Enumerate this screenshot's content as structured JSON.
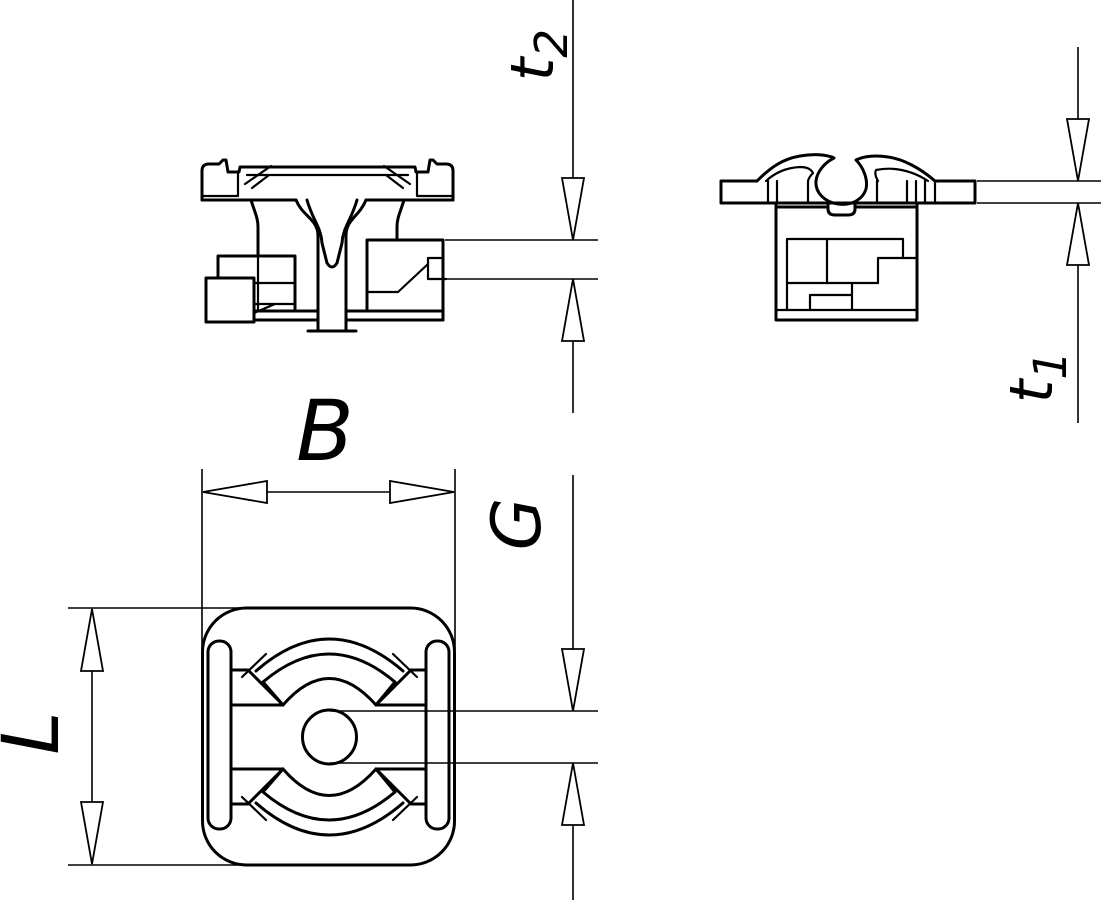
{
  "drawing": {
    "background_color": "#ffffff",
    "line_color": "#000000",
    "dimension_labels": {
      "b": "B",
      "g": "G",
      "l": "L",
      "t1_base": "t",
      "t1_sub": "1",
      "t2_base": "t",
      "t2_sub": "2"
    }
  }
}
